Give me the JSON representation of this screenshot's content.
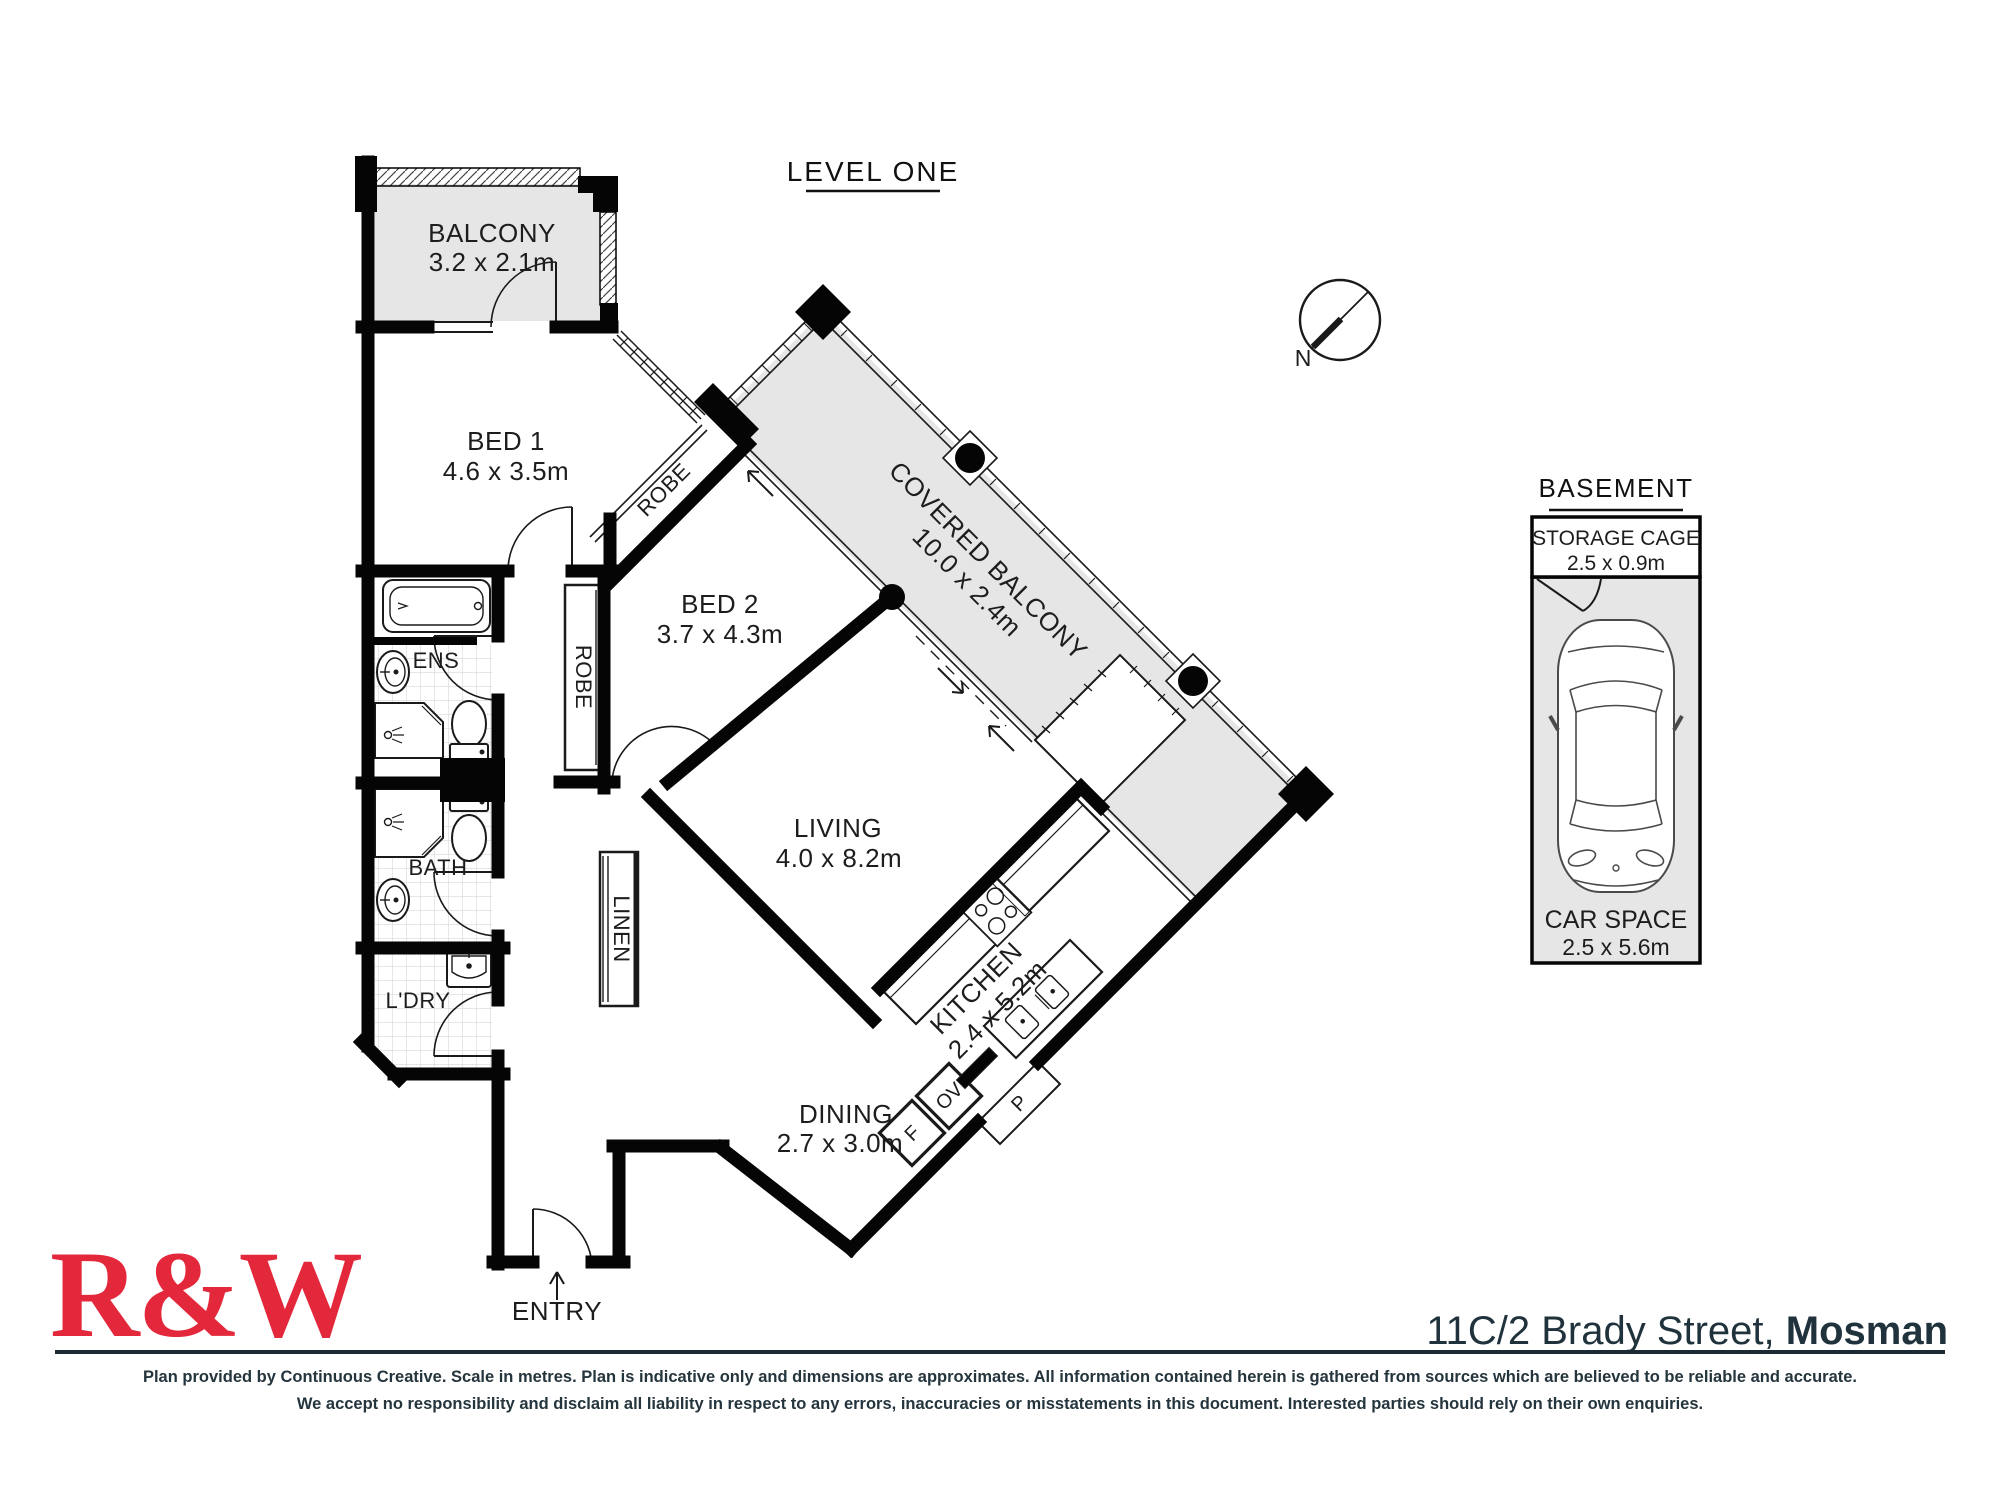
{
  "plan": {
    "level_title": "LEVEL ONE",
    "compass": {
      "north": "N"
    },
    "rooms": {
      "balcony": {
        "name": "BALCONY",
        "dims": "3.2 x 2.1m"
      },
      "bed1": {
        "name": "BED 1",
        "dims": "4.6 x 3.5m"
      },
      "bed2": {
        "name": "BED 2",
        "dims": "3.7 x 4.3m"
      },
      "covered_balcony": {
        "name": "COVERED BALCONY",
        "dims": "10.0 x 2.4m"
      },
      "living": {
        "name": "LIVING",
        "dims": "4.0 x 8.2m"
      },
      "kitchen": {
        "name": "KITCHEN",
        "dims": "2.4 x 5.2m"
      },
      "dining": {
        "name": "DINING",
        "dims": "2.7 x 3.0m"
      },
      "ens": {
        "name": "ENS"
      },
      "bath": {
        "name": "BATH"
      },
      "ldry": {
        "name": "L'DRY"
      },
      "robe1": {
        "name": "ROBE"
      },
      "robe2": {
        "name": "ROBE"
      },
      "linen": {
        "name": "LINEN"
      },
      "entry": {
        "name": "ENTRY"
      }
    },
    "appliances": {
      "fridge": "F",
      "oven": "OV",
      "pantry": "P"
    }
  },
  "basement": {
    "title": "BASEMENT",
    "storage": {
      "name": "STORAGE CAGE",
      "dims": "2.5 x 0.9m"
    },
    "car_space": {
      "name": "CAR SPACE",
      "dims": "2.5 x 5.6m"
    }
  },
  "footer": {
    "logo": "R&W",
    "address_line": "11C/2 Brady Street, ",
    "address_suburb": "Mosman",
    "disclaimer_line1": "Plan provided by Continuous Creative. Scale in metres. Plan is indicative only and dimensions are approximates. All information contained herein is gathered from sources which are believed to be reliable and accurate.",
    "disclaimer_line2": "We accept no responsibility and disclaim all liability in respect to any errors, inaccuracies or misstatements in this document. Interested parties should rely on their own enquiries."
  },
  "colors": {
    "brand_red": "#e4283c",
    "ink": "#20323c",
    "plan_gray": "#e6e6e6",
    "wall": "#050505"
  }
}
